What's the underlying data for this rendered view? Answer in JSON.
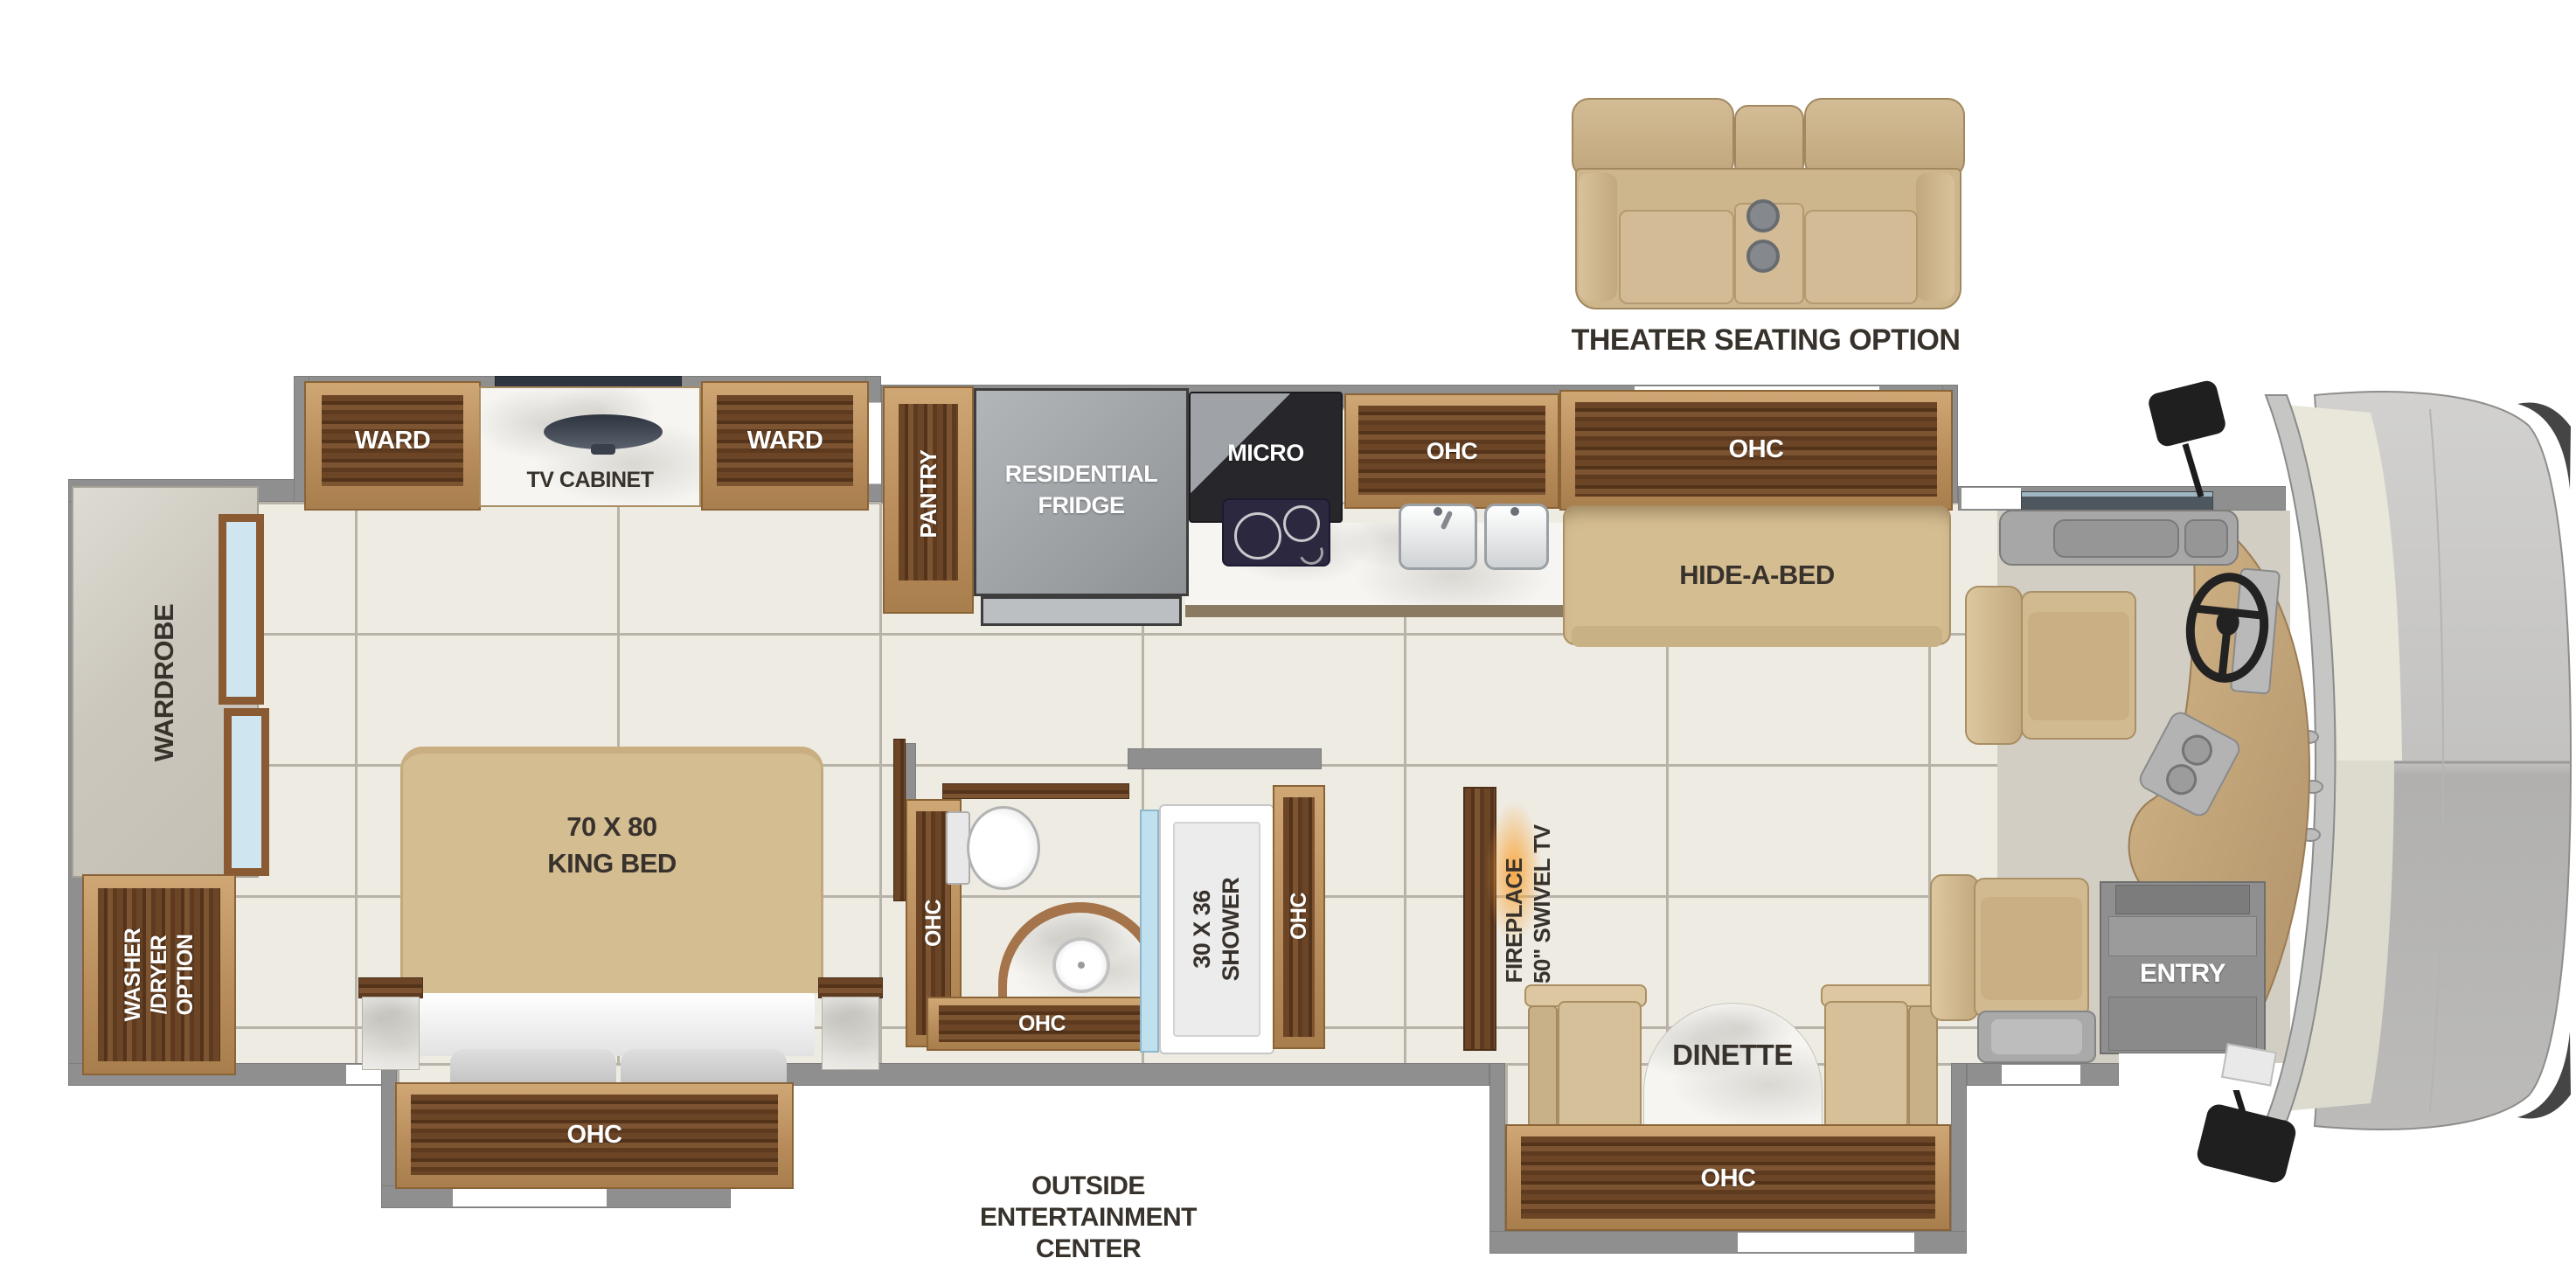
{
  "labels": {
    "theater": "THEATER SEATING OPTION",
    "ward_left": "WARD",
    "tv_cabinet": "TV CABINET",
    "ward_right": "WARD",
    "wardrobe": "WARDROBE",
    "washer_dryer": "WASHER\n/DRYER\nOPTION",
    "king_bed": "70 X 80\nKING BED",
    "bed_ohc": "OHC",
    "pantry": "PANTRY",
    "fridge": "RESIDENTIAL\nFRIDGE",
    "micro": "MICRO",
    "kitchen_ohc_1": "OHC",
    "kitchen_ohc_2": "OHC",
    "hide_a_bed": "HIDE-A-BED",
    "bath_ohc_left": "OHC",
    "bath_ohc_bottom": "OHC",
    "shower": "30 X 36\nSHOWER",
    "bath_ohc_right": "OHC",
    "fireplace": "FIREPLACE\nW/ 50\" SWIVEL TV",
    "dinette": "DINETTE",
    "dinette_ohc": "OHC",
    "entry": "ENTRY",
    "outside_entertainment": "OUTSIDE\nENTERTAINMENT\nCENTER"
  },
  "colors": {
    "wall": "#8f8f8f",
    "tile": "#eeebe2",
    "grout": "#b8b3a8",
    "wood_light": "#b98e5c",
    "wood_dark": "#5e3a1f",
    "sofa_tan": "#d5bd92",
    "cooktop_navy": "#2c2840",
    "fireplace_glow": "#f5a93f",
    "label_dark": "#38322c",
    "label_white": "#ffffff"
  }
}
